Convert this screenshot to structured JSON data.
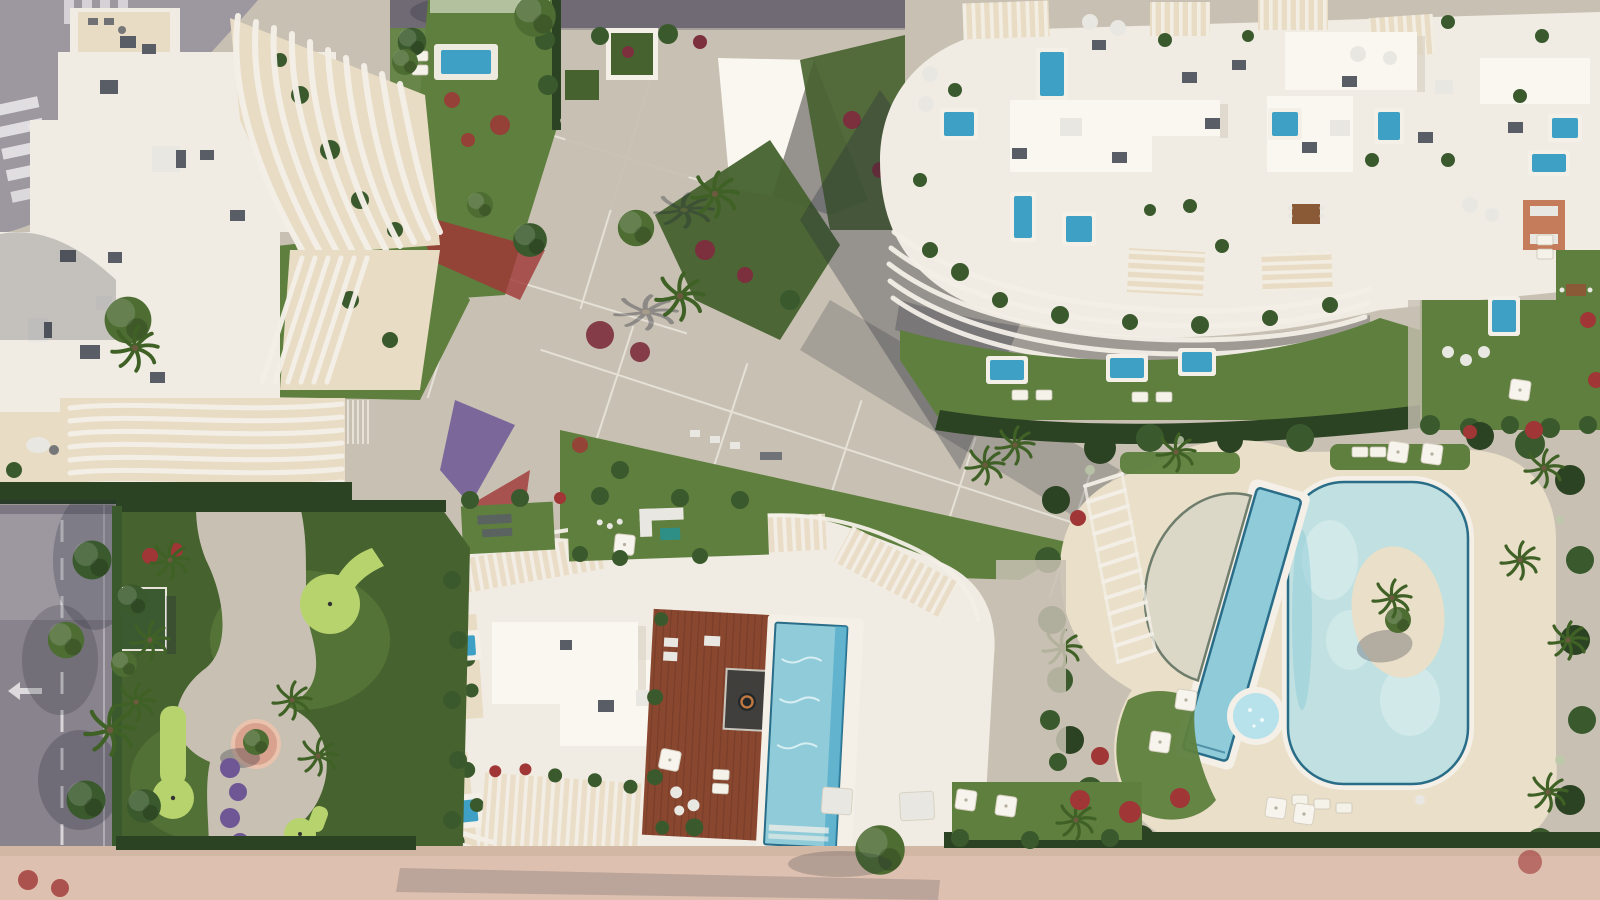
{
  "scene": {
    "title": "Aerial top-down 3D render of a residential resort complex",
    "view": "top-down site plan render",
    "features": [
      "curved-balcony apartment building top-left",
      "penthouse rooftop building top-right with plunge pools and pergolas",
      "diagonal paved central plaza with grid joints and palms",
      "lagoon swimming pool complex with lap pool and jacuzzi",
      "rooftop wooden deck with infinity pool bottom-center",
      "mini-golf garden bottom-left",
      "perimeter road with crosswalk and lane markings",
      "pink promenade along bottom edge"
    ]
  },
  "palette": {
    "roofWhite": "#f1ece3",
    "roofBright": "#faf7f1",
    "roofShade": "#d9d1c3",
    "terrace": "#e9dcc4",
    "sandDeck": "#eadfc8",
    "lawnMid": "#5e7f3e",
    "lawnDark": "#46622e",
    "lawnLight": "#7ea24d",
    "putting": "#b7d36e",
    "hedgeDark": "#2c4323",
    "hedgeMid": "#3a5a2d",
    "hedgeBloom": "#bcc9a9",
    "treeGreen": "#4d6d33",
    "palmGreen": "#3f6126",
    "pavement": "#c8c1b3",
    "pavementDark": "#a9a296",
    "jointWhite": "#eeebe2",
    "roadGray": "#9d98a0",
    "roadDark": "#6f6a74",
    "roadMark": "#eceaec",
    "poolLagoon": "#c0e0e1",
    "poolMid": "#8fcbd9",
    "poolDeep": "#3ea0c4",
    "poolRim": "#2a6d88",
    "jacuzzi": "#b7e2ec",
    "wood": "#8a4730",
    "promenade": "#ddc0af",
    "flowerRed": "#a03636",
    "flowerCrimson": "#7c2f3c",
    "flowerPurple": "#6f5796",
    "shadowBlue": "#232838",
    "unitGray": "#595e66",
    "unitLight": "#e9e7e2",
    "finWhite": "#f4f0e8"
  }
}
